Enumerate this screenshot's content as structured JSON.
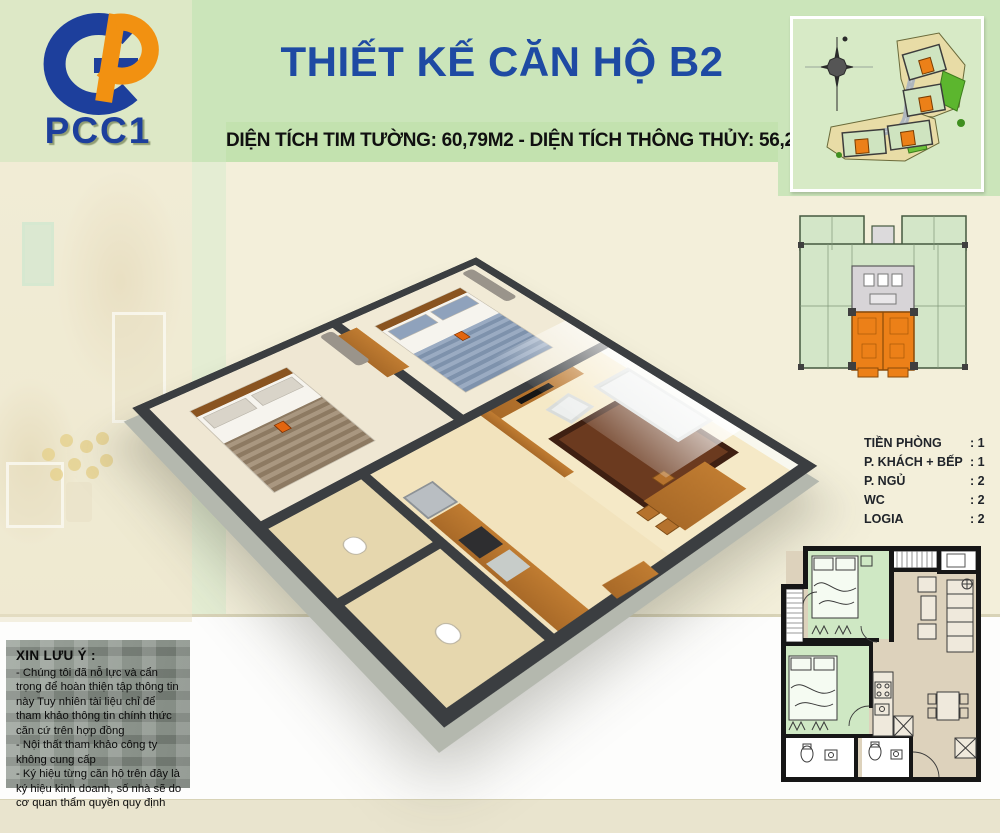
{
  "header": {
    "logo_text": "PCC1",
    "title": "THIẾT KẾ CĂN HỘ B2",
    "subtitle": "DIỆN TÍCH TIM TƯỜNG: 60,79M2 - DIỆN TÍCH THÔNG THỦY: 56,2M2"
  },
  "room_list": {
    "items": [
      {
        "label": "TIỀN PHÒNG",
        "value": ":  1"
      },
      {
        "label": "P. KHÁCH + BẾP",
        "value": ":  1"
      },
      {
        "label": "P. NGỦ",
        "value": ":  2"
      },
      {
        "label": "WC",
        "value": ":  2"
      },
      {
        "label": "LOGIA",
        "value": ":  2"
      }
    ]
  },
  "disclaimer": {
    "heading": "XIN LƯU Ý :",
    "notes": [
      "-   Chúng tôi đã nỗ lực và cẩn trọng để hoàn thiện tập thông tin này Tuy nhiên tài liệu chỉ để tham khảo thông tin chính thức căn cứ trên hợp đồng",
      "-   Nội thất tham khảo công ty không cung cấp",
      "-   Ký hiệu từng căn hộ trên đây là ký hiệu kinh doanh, số nhà sẽ do cơ quan thẩm quyền quy định"
    ]
  },
  "figures": {
    "site_plan": "site-plan-thumbnail-with-compass",
    "floor_plate": "typical-floor-plan-unit-b2-highlighted-orange",
    "unit_plan_3d": "apartment-b2-3d-isometric-cutaway",
    "unit_plan_2d": "apartment-b2-2d-floor-plan"
  },
  "colors": {
    "header_green": "#cbe5ba",
    "logo_block_green": "#dde8c6",
    "cream": "#f3efda",
    "title_blue": "#1e4aa3",
    "unit_highlight_orange": "#ec8018",
    "plan_room_green": "#cfe8c4",
    "wall_dark": "#3b3e41",
    "arrow_red": "#e01010"
  }
}
